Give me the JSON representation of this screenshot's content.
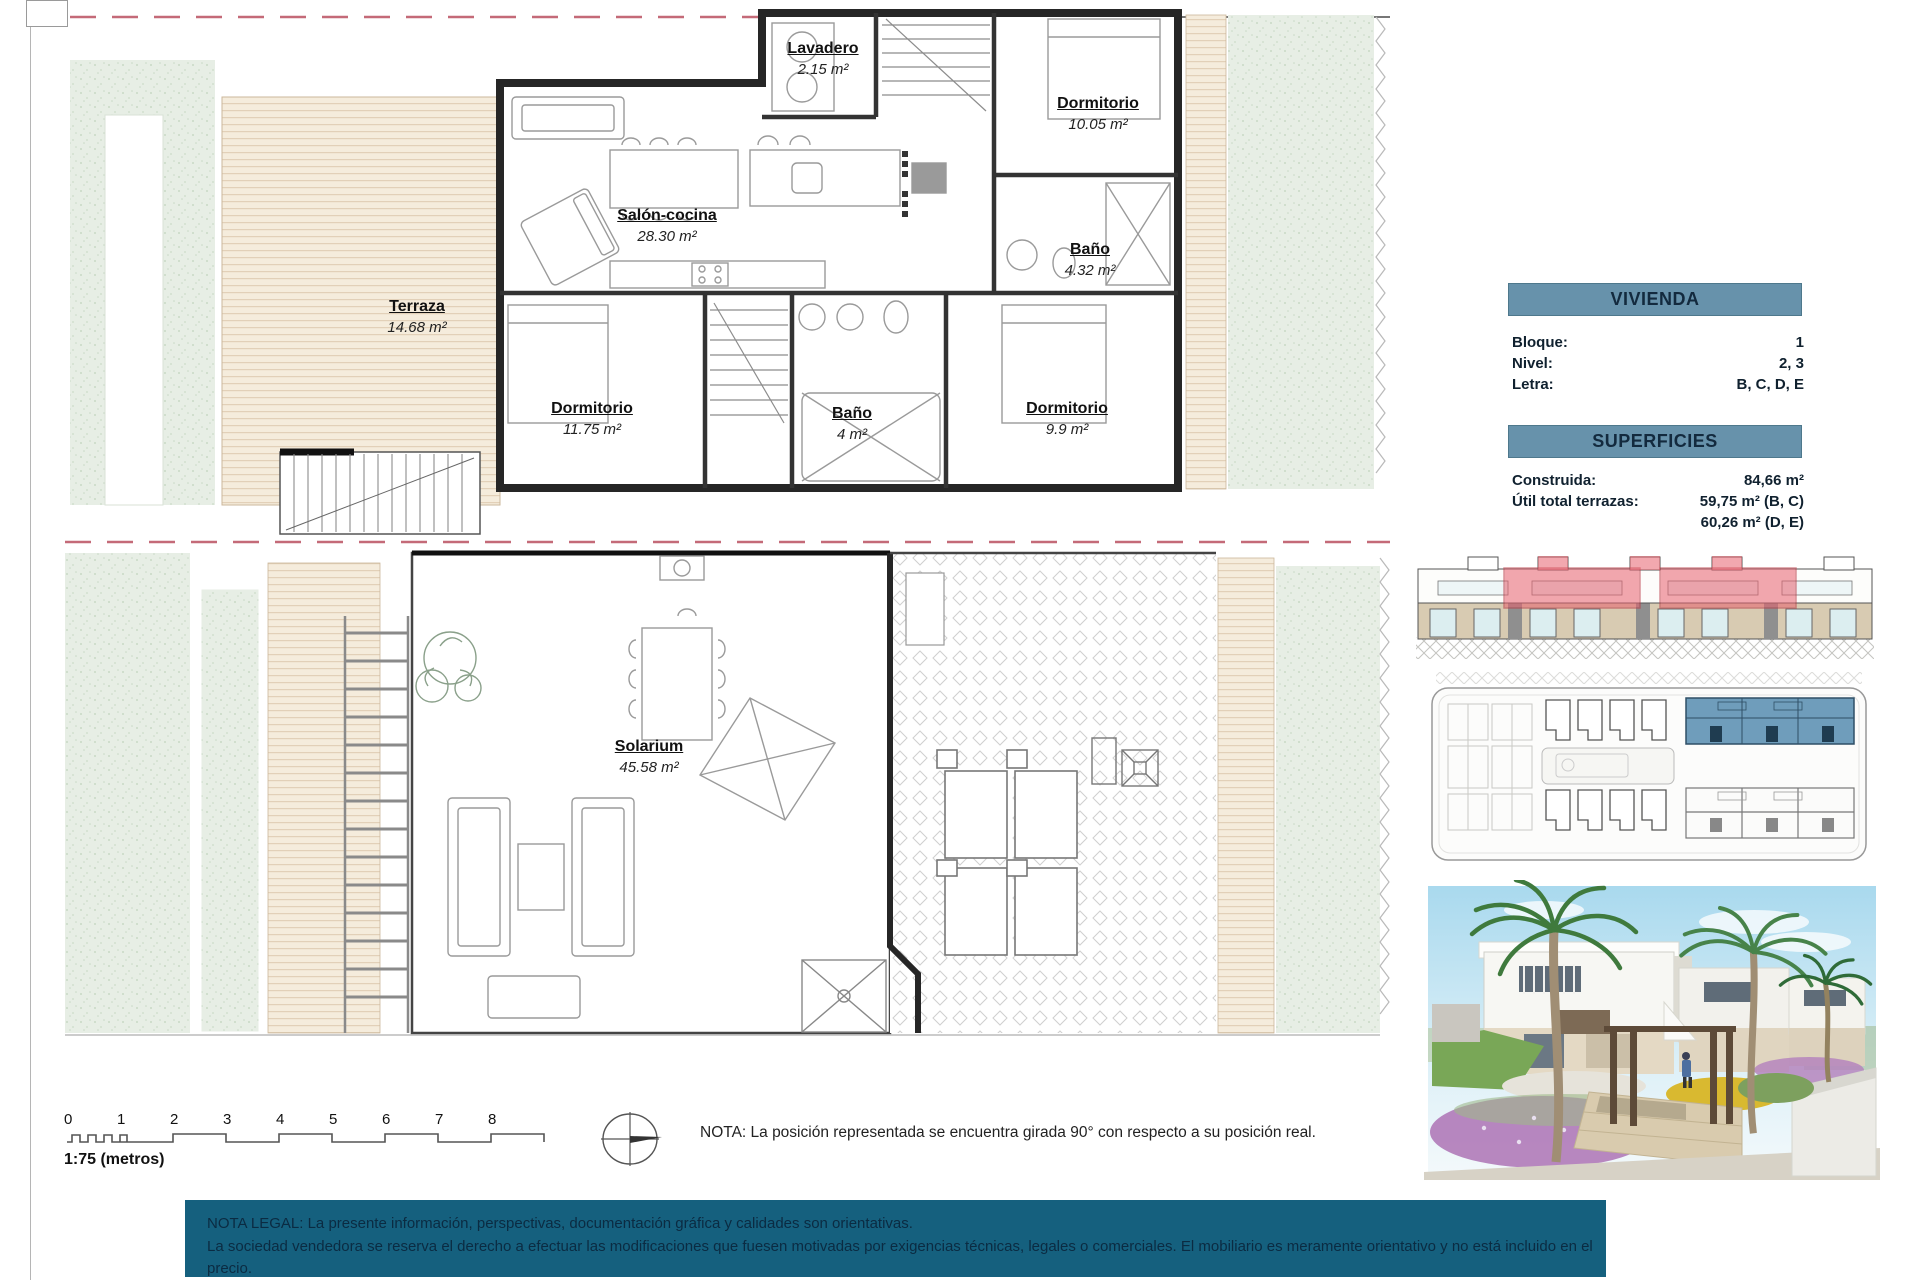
{
  "plan_top": {
    "rooms": [
      {
        "name": "Lavadero",
        "area": "2.15 m²"
      },
      {
        "name": "Dormitorio",
        "area": "10.05 m²"
      },
      {
        "name": "Salón-cocina",
        "area": "28.30 m²"
      },
      {
        "name": "Terraza",
        "area": "14.68 m²"
      },
      {
        "name": "Baño",
        "area": "4.32 m²"
      },
      {
        "name": "Dormitorio",
        "area": "11.75 m²"
      },
      {
        "name": "Baño",
        "area": "4 m²"
      },
      {
        "name": "Dormitorio",
        "area": "9.9 m²"
      }
    ]
  },
  "plan_bottom": {
    "rooms": [
      {
        "name": "Solarium",
        "area": "45.58 m²"
      }
    ]
  },
  "vivienda": {
    "title": "VIVIENDA",
    "rows": [
      {
        "label": "Bloque:",
        "value": "1"
      },
      {
        "label": "Nivel:",
        "value": "2, 3"
      },
      {
        "label": "Letra:",
        "value": "B, C, D, E"
      }
    ]
  },
  "superficies": {
    "title": "SUPERFICIES",
    "rows": [
      {
        "label": "Construida:",
        "value": "84,66 m²"
      },
      {
        "label": "Útil total terrazas:",
        "value": "59,75 m² (B, C)",
        "value2": "60,26 m² (D, E)"
      }
    ]
  },
  "scale_bar": {
    "ticks": [
      "0",
      "1",
      "2",
      "3",
      "4",
      "5",
      "6",
      "7",
      "8"
    ],
    "label": "1:75 (metros)"
  },
  "nota": "NOTA: La posición representada se encuentra girada 90° con respecto a su posición real.",
  "legal": {
    "line1": "NOTA LEGAL: La presente información, perspectivas, documentación gráfica y calidades son orientativas.",
    "line2": "La sociedad vendedora se reserva el derecho a efectuar las modificaciones que fuesen motivadas por exigencias técnicas, legales o comerciales. El mobiliario es meramente orientativo y no está incluido en el precio."
  },
  "colors": {
    "panel_header": "#6792ab",
    "legal_bar": "#15607e",
    "elevation_highlight": "#e8606e",
    "siteplan_highlight": "#6f9dbb",
    "boundary_dash": "#c46a78",
    "garden_green": "#e7eee5",
    "deck_beige": "#f5ecdc"
  }
}
